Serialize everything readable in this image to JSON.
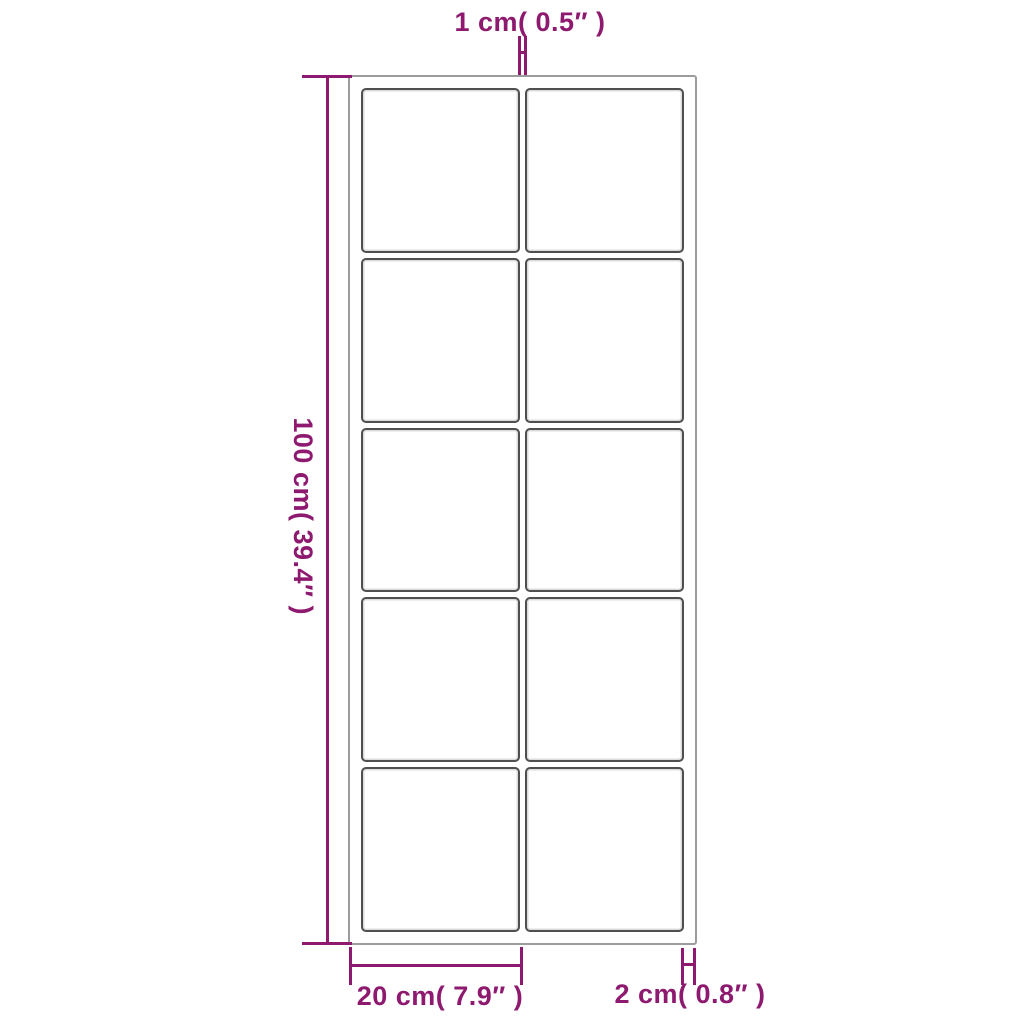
{
  "figure": {
    "type": "product-dimension-diagram",
    "background_color": "#ffffff",
    "accent_color": "#8e1a70",
    "outer_frame_color": "#9c9c9c",
    "pane_border_color": "#4f4f4f",
    "grid": {
      "columns": 2,
      "rows": 5,
      "pane_count": 10
    }
  },
  "dimensions": {
    "top_bar_width": {
      "label": "1 cm( 0.5″ )"
    },
    "overall_height": {
      "label": "100 cm( 39.4″ )"
    },
    "pane_column_width": {
      "label": "20 cm( 7.9″ )"
    },
    "frame_depth": {
      "label": "2 cm( 0.8″ )"
    }
  }
}
